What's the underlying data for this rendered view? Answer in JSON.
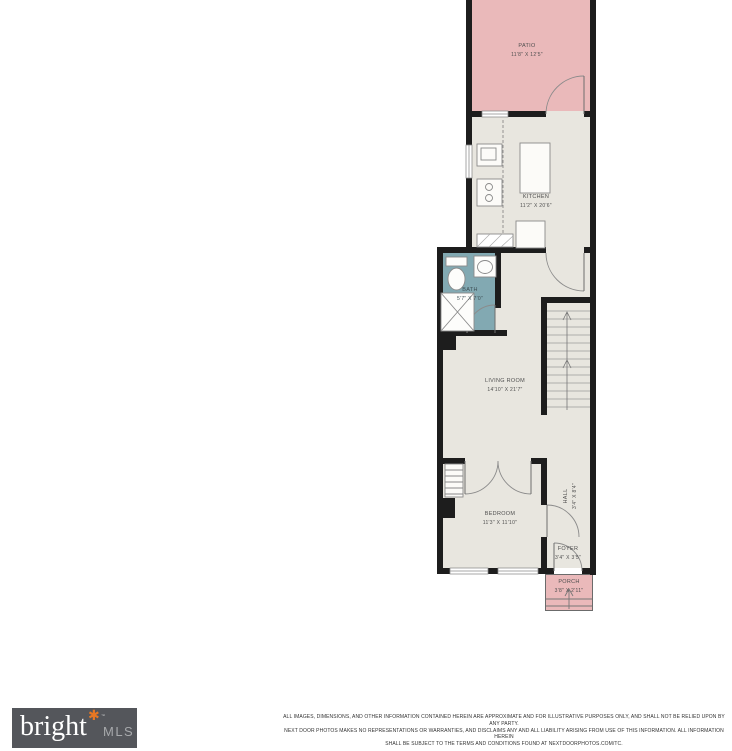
{
  "colors": {
    "floor": "#e8e6df",
    "patio_pink": "#eab9ba",
    "bath_teal": "#82a9b2",
    "wall": "#1d1d1d",
    "label_text": "#4f4f4f",
    "fixture_line": "#8a8a8a",
    "logo_bg": "#54565b",
    "logo_text": "#ffffff",
    "logo_mls_text": "#a7a9ac",
    "logo_asterisk": "#e87722"
  },
  "rooms": {
    "patio": {
      "name": "PATIO",
      "dims": "11'8\" X 12'5\""
    },
    "kitchen": {
      "name": "KITCHEN",
      "dims": "11'2\" X 20'6\""
    },
    "bath": {
      "name": "BATH",
      "dims": "5'7\" X 7'0\""
    },
    "living_room": {
      "name": "LIVING ROOM",
      "dims": "14'10\" X 21'7\""
    },
    "bedroom": {
      "name": "BEDROOM",
      "dims": "11'3\" X 11'10\""
    },
    "hall": {
      "name": "HALL",
      "dims": "3'4\" X 8'4\""
    },
    "foyer": {
      "name": "FOYER",
      "dims": "3'4\" X 3'5\""
    },
    "porch": {
      "name": "PORCH",
      "dims": "3'8\" X 2'11\""
    }
  },
  "footer": {
    "logo": {
      "brand": "bright",
      "asterisk": "✱",
      "tm": "™",
      "suffix": "MLS"
    },
    "disclaimer": [
      "ALL IMAGES, DIMENSIONS, AND OTHER INFORMATION CONTAINED HEREIN ARE APPROXIMATE AND FOR ILLUSTRATIVE PURPOSES ONLY, AND SHALL NOT BE RELIED UPON BY ANY PARTY.",
      "NEXT DOOR PHOTOS MAKES NO REPRESENTATIONS OR WARRANTIES, AND DISCLAIMS ANY AND ALL LIABILITY ARISING FROM USE OF THIS INFORMATION. ALL INFORMATION HEREIN",
      "SHALL BE SUBJECT TO THE TERMS AND CONDITIONS FOUND AT NEXTDOORPHOTOS.COM/TC."
    ]
  }
}
